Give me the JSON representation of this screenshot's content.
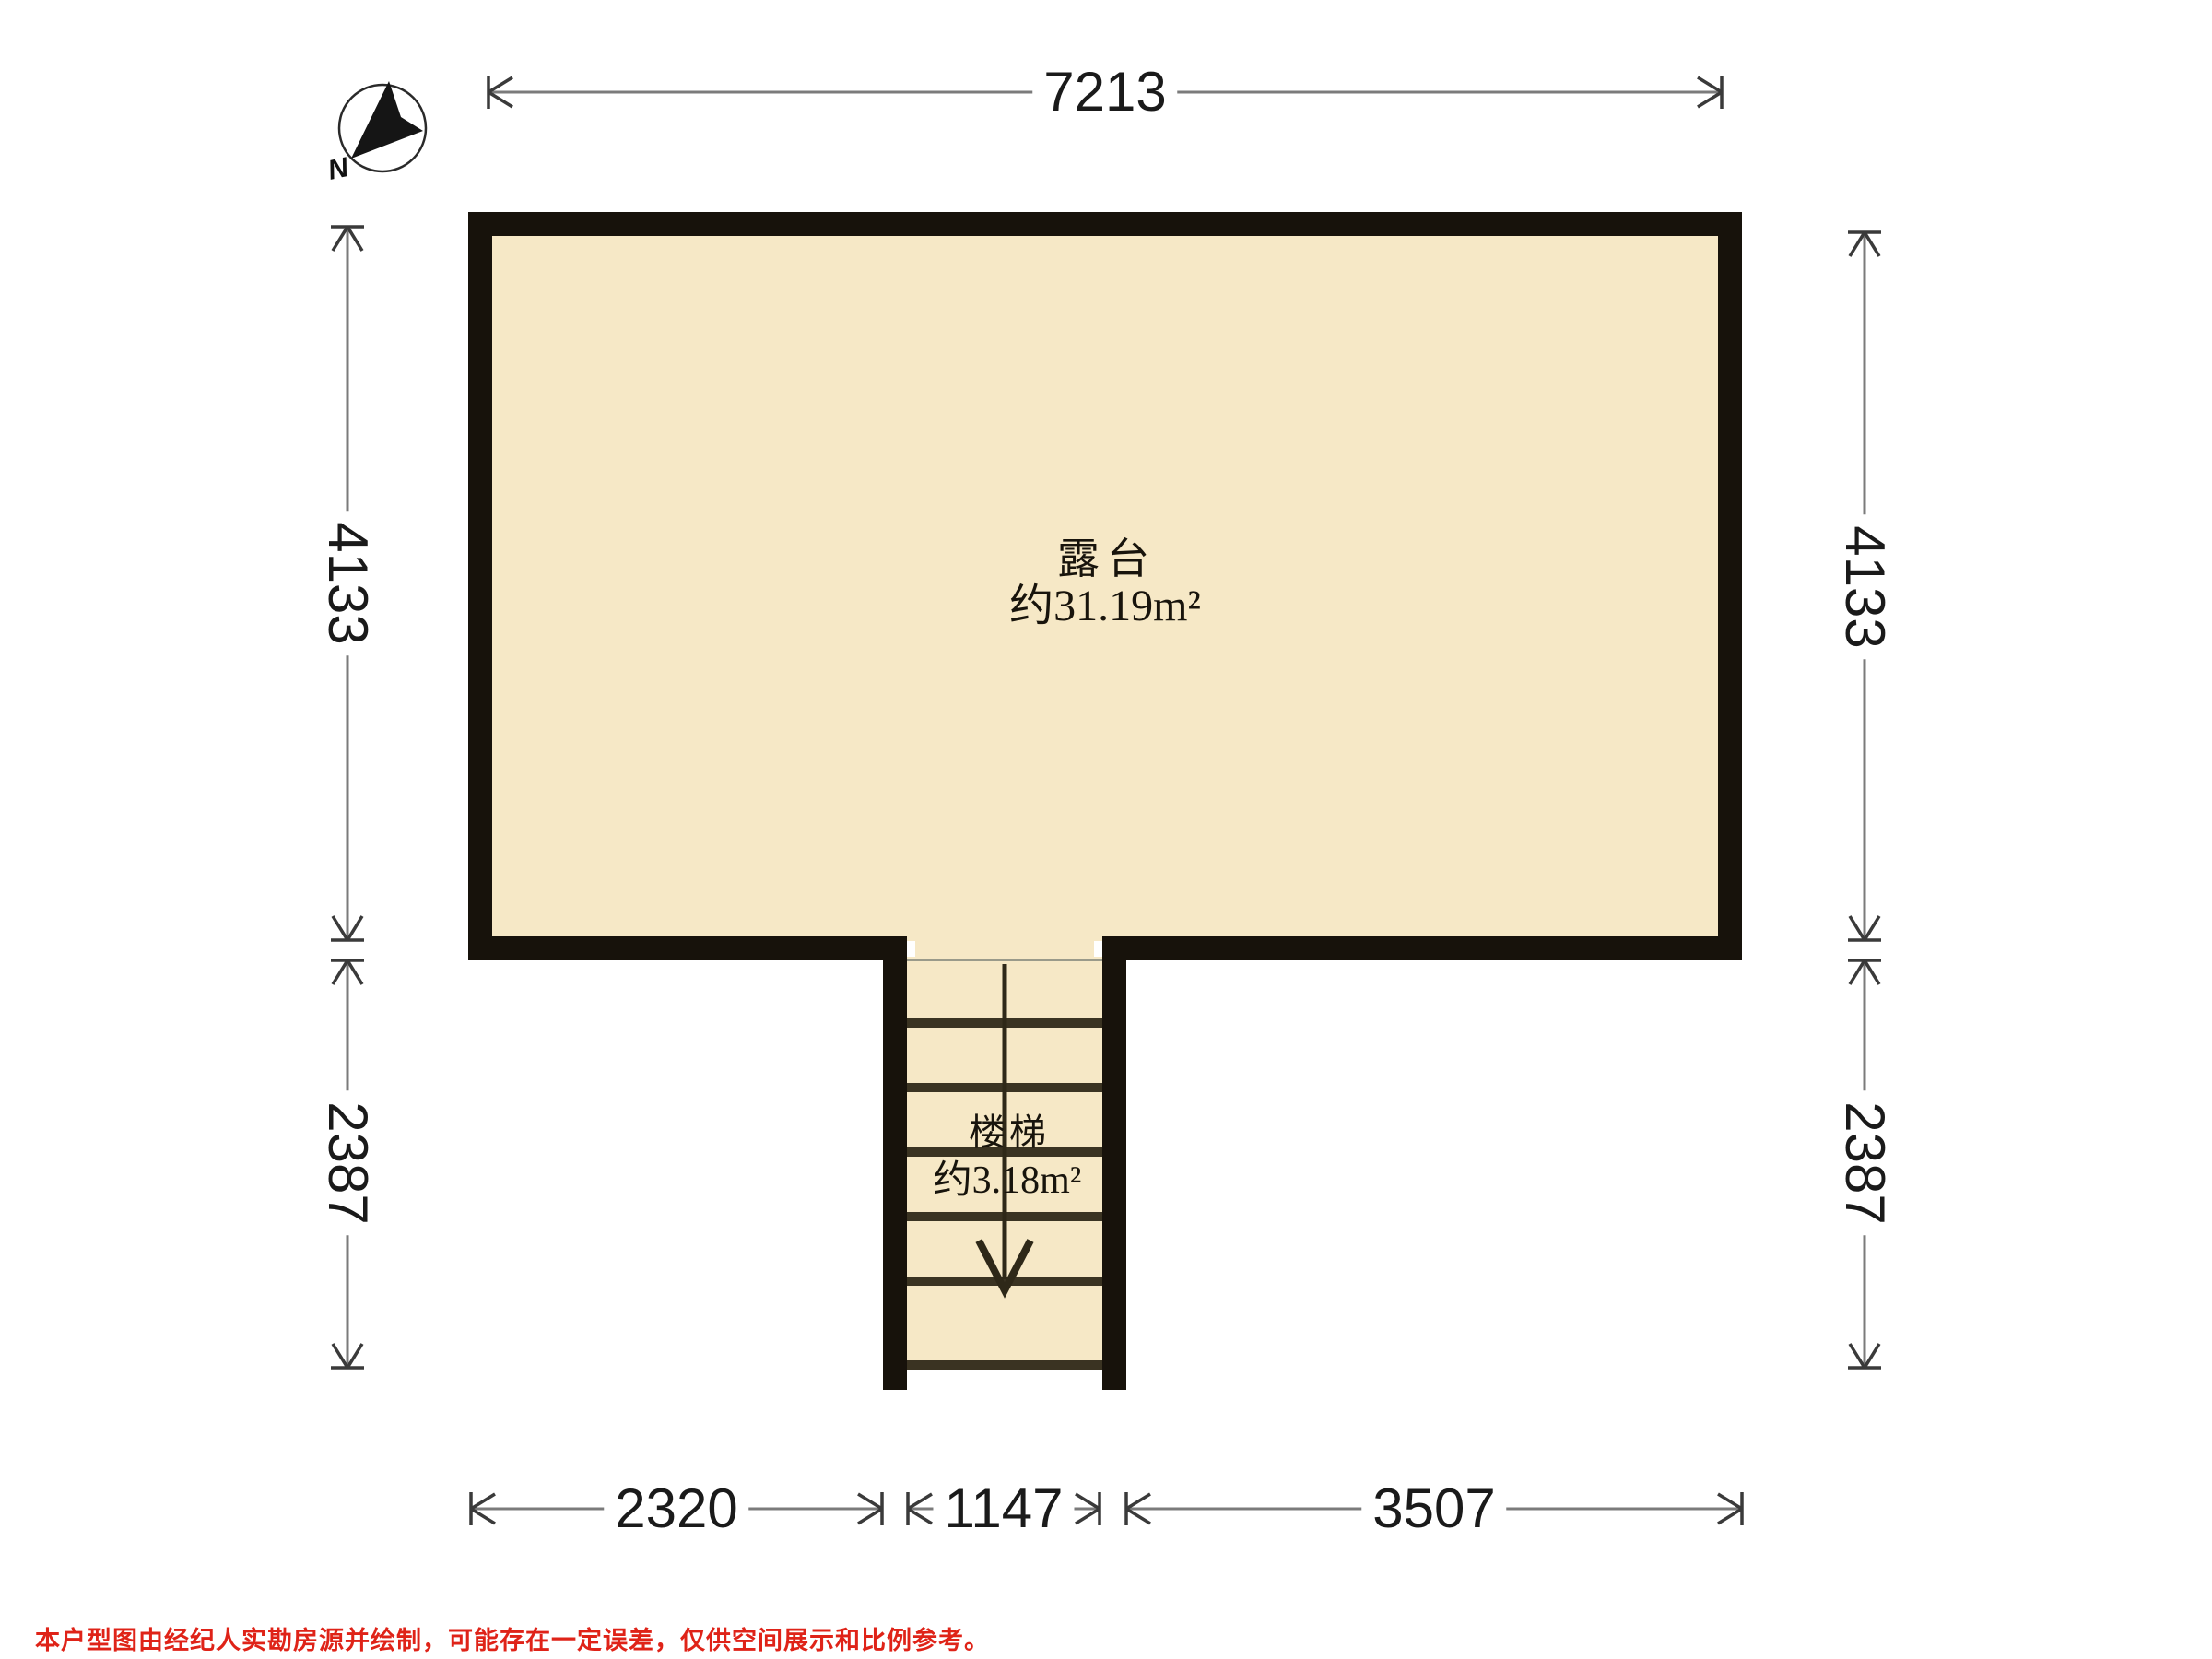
{
  "compass": {
    "north_label": "N"
  },
  "rooms": {
    "terrace": {
      "name": "露台",
      "area": "约31.19m²"
    },
    "stairs": {
      "name": "楼梯",
      "area": "约3.18m²"
    }
  },
  "dimensions": {
    "top_width": "7213",
    "left_upper": "4133",
    "left_lower": "2387",
    "right_upper": "4133",
    "right_lower": "2387",
    "bottom_left": "2320",
    "bottom_center": "1147",
    "bottom_right": "3507"
  },
  "icons": {
    "compass": "north-compass-icon",
    "stairs_arrow": "stairs-down-arrow-icon"
  },
  "disclaimer": "本户型图由经纪人实勘房源并绘制，可能存在一定误差，仅供空间展示和比例参考。",
  "colors": {
    "background": "#ffffff",
    "floor_fill": "#f6e8c6",
    "wall": "#17120b",
    "tread_line": "#3a3322",
    "stair_arrow": "#2e2818",
    "dimension_line": "#7b7b7b",
    "tick_color": "#3a3a3a",
    "dimension_text": "#1a1a1a",
    "disclaimer_red": "#df2318"
  }
}
